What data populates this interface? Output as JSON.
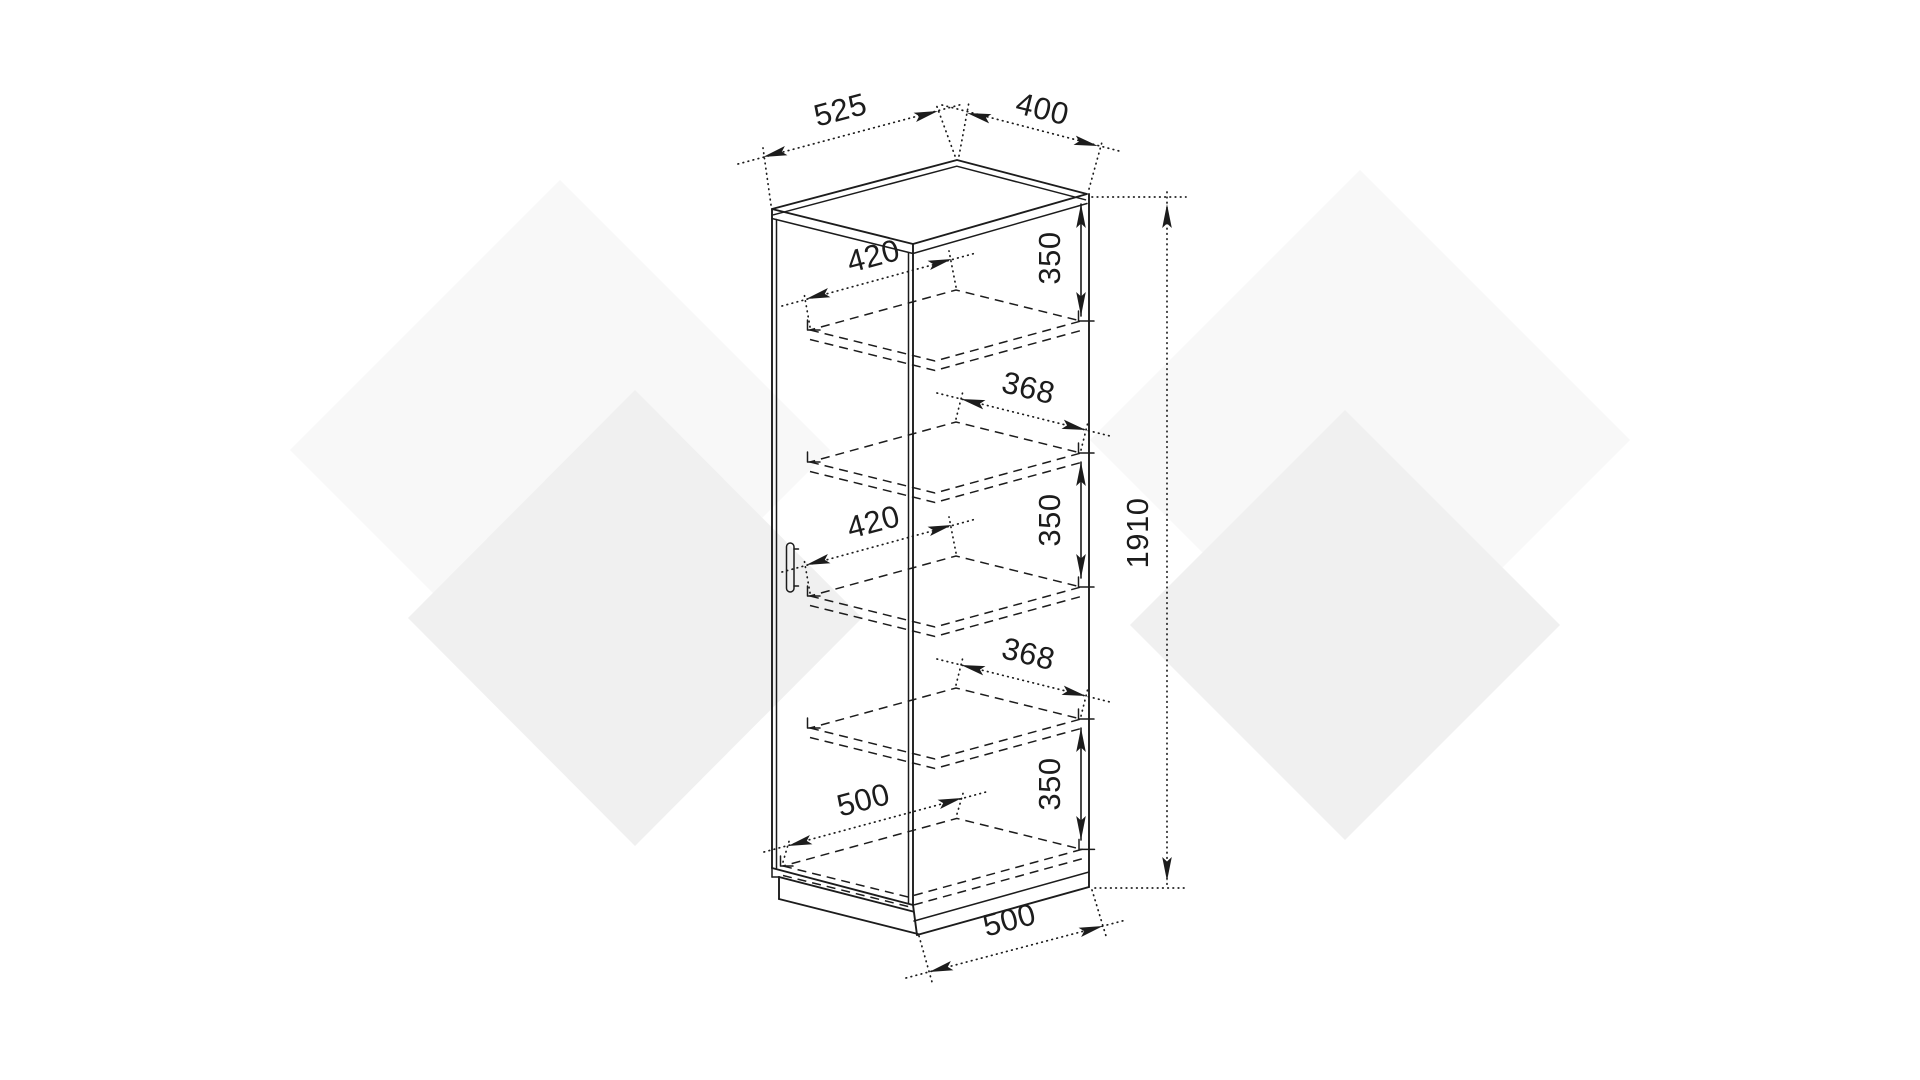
{
  "document": {
    "kind": "furniture-technical-drawing",
    "subject": "tall single-door cabinet with shelves, isometric dimensioned view"
  },
  "labels": {
    "top_depth": "525",
    "top_width": "400",
    "shelf_depth_upper": "420",
    "inner_width_upper": "368",
    "shelf_depth_lower": "420",
    "inner_width_lower": "368",
    "bottom_depth": "500",
    "base_depth": "500",
    "gap_top": "350",
    "gap_middle": "350",
    "gap_bottom": "350",
    "total_height": "1910"
  },
  "colors": {
    "line": "#1c1c1c",
    "background": "#ffffff",
    "watermark_light": "#f8f8f8",
    "watermark_dark": "#f0f0f0"
  }
}
